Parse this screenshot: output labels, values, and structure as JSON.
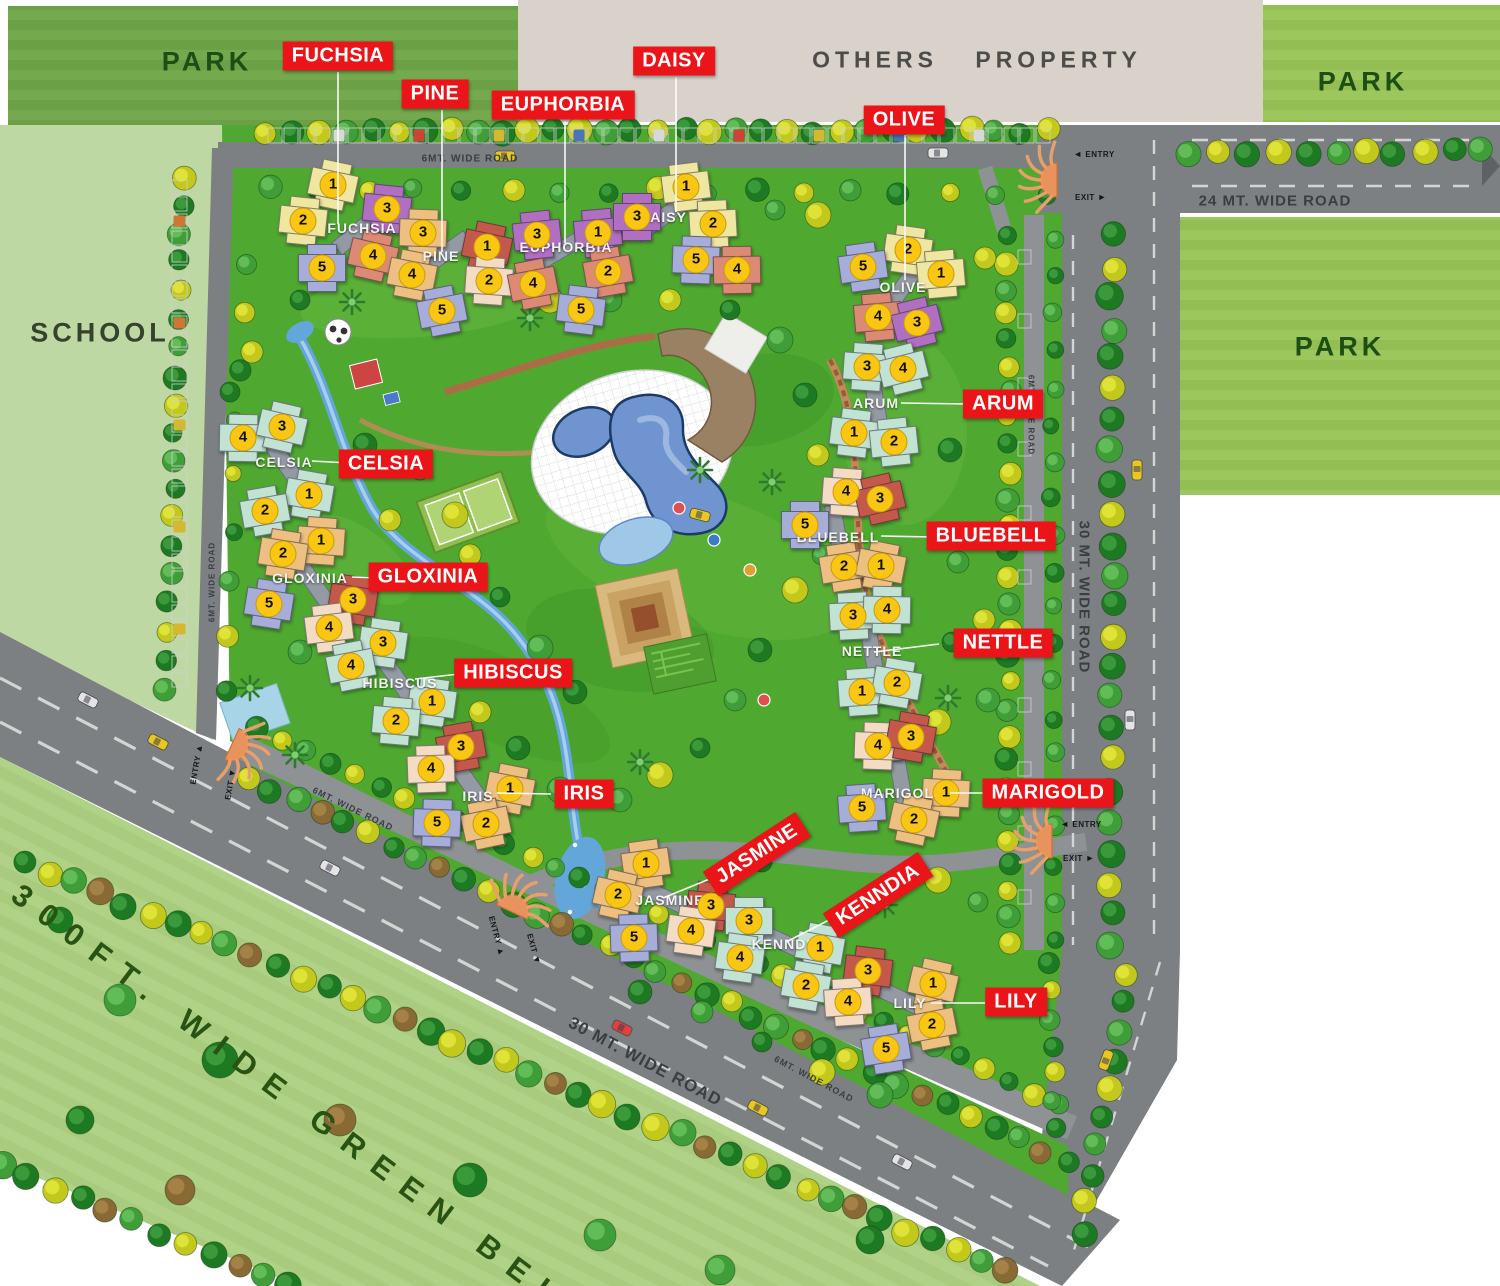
{
  "areas": {
    "park_top_left": {
      "label": "PARK",
      "x": 207,
      "y": 62
    },
    "park_top_right": {
      "label": "PARK",
      "x": 1363,
      "y": 82
    },
    "park_right": {
      "label": "PARK",
      "x": 1340,
      "y": 347
    },
    "school": {
      "label": "SCHOOL",
      "x": 100,
      "y": 333
    },
    "others_property": {
      "label": "OTHERS PROPERTY",
      "x": 977,
      "y": 60
    },
    "green_belt": {
      "label": "300FT. WIDE GREEN BELT",
      "x": 303,
      "y": 1108,
      "rot": 37
    }
  },
  "road_labels": [
    {
      "text": "6MT. WIDE ROAD",
      "x": 470,
      "y": 159,
      "rot": 0,
      "size": 10
    },
    {
      "text": "24 MT. WIDE ROAD",
      "x": 1275,
      "y": 201,
      "rot": 0,
      "size": 15
    },
    {
      "text": "30 MT. WIDE ROAD",
      "x": 1084,
      "y": 597,
      "rot": 90,
      "size": 15
    },
    {
      "text": "6MT. WIDE ROAD",
      "x": 1031,
      "y": 415,
      "rot": 90,
      "size": 8
    },
    {
      "text": "6MT. WIDE ROAD",
      "x": 212,
      "y": 582,
      "rot": -90,
      "size": 8
    },
    {
      "text": "30 MT. WIDE ROAD",
      "x": 645,
      "y": 1062,
      "rot": 28,
      "size": 17
    },
    {
      "text": "6MT. WIDE ROAD",
      "x": 814,
      "y": 1079,
      "rot": 28,
      "size": 9
    },
    {
      "text": "6MT. WIDE ROAD",
      "x": 353,
      "y": 809,
      "rot": 26,
      "size": 9
    }
  ],
  "gates": [
    {
      "x": 1057,
      "y": 180,
      "dir": 180,
      "labels": [
        {
          "text": "ENTRY",
          "arrow": "◄",
          "x": 1094,
          "y": 154,
          "rot": 0
        },
        {
          "text": "EXIT",
          "arrow": "►",
          "x": 1091,
          "y": 197,
          "rot": 0
        }
      ]
    },
    {
      "x": 1052,
      "y": 841,
      "dir": 180,
      "labels": [
        {
          "text": "ENTRY",
          "arrow": "◄",
          "x": 1081,
          "y": 824,
          "rot": 0
        },
        {
          "text": "EXIT",
          "arrow": "►",
          "x": 1079,
          "y": 858,
          "rot": 0
        }
      ]
    },
    {
      "x": 512,
      "y": 912,
      "dir": -65,
      "labels": [
        {
          "text": "ENTRY",
          "arrow": "▲",
          "x": 497,
          "y": 936,
          "rot": 75
        },
        {
          "text": "EXIT",
          "arrow": "▼",
          "x": 534,
          "y": 949,
          "rot": 75
        }
      ]
    },
    {
      "x": 232,
      "y": 744,
      "dir": 25,
      "labels": [
        {
          "text": "ENTRY",
          "arrow": "▲",
          "x": 196,
          "y": 764,
          "rot": -80
        },
        {
          "text": "EXIT",
          "arrow": "▼",
          "x": 230,
          "y": 784,
          "rot": -80
        }
      ]
    }
  ],
  "palette": {
    "yellow": "#efe6a2",
    "purple": "#b06fc1",
    "orange": "#edbf80",
    "salmon": "#dd8a74",
    "lavender": "#a7add9",
    "teal": "#c2e3d4",
    "peach": "#f3dcc3",
    "red": "#c4584a"
  },
  "clusters": [
    {
      "name": "FUCHSIA",
      "label": {
        "x": 362,
        "y": 228
      },
      "spine": -40,
      "callout": {
        "x": 338,
        "y": 56,
        "rot": 0
      },
      "leader": [
        338,
        72,
        338,
        224
      ],
      "towers": [
        {
          "n": "1",
          "x": 333,
          "y": 185,
          "c": "yellow"
        },
        {
          "n": "2",
          "x": 303,
          "y": 221,
          "c": "yellow"
        },
        {
          "n": "3",
          "x": 387,
          "y": 209,
          "c": "purple"
        },
        {
          "n": "4",
          "x": 373,
          "y": 256,
          "c": "salmon"
        },
        {
          "n": "5",
          "x": 322,
          "y": 268,
          "c": "lavender"
        }
      ]
    },
    {
      "name": "PINE",
      "label": {
        "x": 441,
        "y": 256
      },
      "spine": -35,
      "callout": {
        "x": 435,
        "y": 94,
        "rot": 0
      },
      "leader": [
        442,
        110,
        442,
        252
      ],
      "towers": [
        {
          "n": "3",
          "x": 423,
          "y": 233,
          "c": "orange"
        },
        {
          "n": "4",
          "x": 412,
          "y": 275,
          "c": "orange"
        },
        {
          "n": "1",
          "x": 487,
          "y": 247,
          "c": "red"
        },
        {
          "n": "2",
          "x": 489,
          "y": 281,
          "c": "peach"
        },
        {
          "n": "5",
          "x": 442,
          "y": 311,
          "c": "lavender"
        }
      ]
    },
    {
      "name": "EUPHORBIA",
      "label": {
        "x": 566,
        "y": 247
      },
      "spine": -30,
      "callout": {
        "x": 563,
        "y": 105,
        "rot": 0
      },
      "leader": [
        565,
        121,
        565,
        243
      ],
      "towers": [
        {
          "n": "3",
          "x": 537,
          "y": 235,
          "c": "purple"
        },
        {
          "n": "4",
          "x": 533,
          "y": 284,
          "c": "salmon"
        },
        {
          "n": "1",
          "x": 598,
          "y": 233,
          "c": "purple"
        },
        {
          "n": "2",
          "x": 608,
          "y": 272,
          "c": "salmon"
        },
        {
          "n": "5",
          "x": 581,
          "y": 310,
          "c": "lavender"
        }
      ]
    },
    {
      "name": "DAISY",
      "label": {
        "x": 663,
        "y": 217
      },
      "spine": -35,
      "callout": {
        "x": 674,
        "y": 61,
        "rot": 0
      },
      "leader": [
        676,
        77,
        676,
        212
      ],
      "towers": [
        {
          "n": "1",
          "x": 686,
          "y": 187,
          "c": "yellow"
        },
        {
          "n": "3",
          "x": 637,
          "y": 217,
          "c": "purple"
        },
        {
          "n": "2",
          "x": 713,
          "y": 224,
          "c": "yellow"
        },
        {
          "n": "5",
          "x": 696,
          "y": 260,
          "c": "lavender"
        },
        {
          "n": "4",
          "x": 737,
          "y": 270,
          "c": "salmon"
        }
      ]
    },
    {
      "name": "OLIVE",
      "label": {
        "x": 903,
        "y": 287
      },
      "spine": -55,
      "callout": {
        "x": 904,
        "y": 120,
        "rot": 0
      },
      "leader": [
        905,
        135,
        905,
        280
      ],
      "towers": [
        {
          "n": "2",
          "x": 908,
          "y": 250,
          "c": "yellow"
        },
        {
          "n": "1",
          "x": 941,
          "y": 274,
          "c": "yellow"
        },
        {
          "n": "5",
          "x": 863,
          "y": 267,
          "c": "lavender"
        },
        {
          "n": "4",
          "x": 878,
          "y": 317,
          "c": "salmon"
        },
        {
          "n": "3",
          "x": 917,
          "y": 323,
          "c": "purple"
        }
      ]
    },
    {
      "name": "CELSIA",
      "label": {
        "x": 284,
        "y": 462
      },
      "spine": 55,
      "callout": {
        "x": 386,
        "y": 464,
        "rot": 0
      },
      "leader": [
        349,
        463,
        312,
        461
      ],
      "towers": [
        {
          "n": "4",
          "x": 243,
          "y": 438,
          "c": "teal"
        },
        {
          "n": "3",
          "x": 282,
          "y": 427,
          "c": "teal"
        },
        {
          "n": "1",
          "x": 309,
          "y": 495,
          "c": "teal"
        },
        {
          "n": "2",
          "x": 265,
          "y": 511,
          "c": "teal"
        }
      ]
    },
    {
      "name": "GLOXINIA",
      "label": {
        "x": 310,
        "y": 578
      },
      "spine": 55,
      "callout": {
        "x": 428,
        "y": 577,
        "rot": 0
      },
      "leader": [
        374,
        578,
        352,
        577
      ],
      "towers": [
        {
          "n": "1",
          "x": 321,
          "y": 541,
          "c": "orange"
        },
        {
          "n": "2",
          "x": 283,
          "y": 554,
          "c": "orange"
        },
        {
          "n": "3",
          "x": 353,
          "y": 600,
          "c": "red"
        },
        {
          "n": "5",
          "x": 269,
          "y": 604,
          "c": "lavender"
        },
        {
          "n": "4",
          "x": 329,
          "y": 628,
          "c": "peach"
        }
      ]
    },
    {
      "name": "HIBISCUS",
      "label": {
        "x": 400,
        "y": 683
      },
      "spine": 55,
      "callout": {
        "x": 513,
        "y": 673,
        "rot": 0
      },
      "leader": [
        459,
        674,
        415,
        679
      ],
      "towers": [
        {
          "n": "3",
          "x": 383,
          "y": 643,
          "c": "teal"
        },
        {
          "n": "4",
          "x": 351,
          "y": 666,
          "c": "teal"
        },
        {
          "n": "1",
          "x": 432,
          "y": 702,
          "c": "teal"
        },
        {
          "n": "2",
          "x": 396,
          "y": 721,
          "c": "teal"
        }
      ]
    },
    {
      "name": "IRIS",
      "label": {
        "x": 478,
        "y": 796
      },
      "spine": 55,
      "callout": {
        "x": 584,
        "y": 794,
        "rot": 0
      },
      "leader": [
        551,
        794,
        497,
        793
      ],
      "towers": [
        {
          "n": "3",
          "x": 461,
          "y": 747,
          "c": "red"
        },
        {
          "n": "4",
          "x": 431,
          "y": 769,
          "c": "peach"
        },
        {
          "n": "1",
          "x": 510,
          "y": 789,
          "c": "orange"
        },
        {
          "n": "2",
          "x": 486,
          "y": 824,
          "c": "orange"
        },
        {
          "n": "5",
          "x": 437,
          "y": 823,
          "c": "lavender"
        }
      ]
    },
    {
      "name": "ARUM",
      "label": {
        "x": 876,
        "y": 403
      },
      "spine": 80,
      "callout": {
        "x": 1003,
        "y": 404,
        "rot": 0
      },
      "leader": [
        967,
        404,
        901,
        403
      ],
      "towers": [
        {
          "n": "3",
          "x": 867,
          "y": 367,
          "c": "teal"
        },
        {
          "n": "4",
          "x": 903,
          "y": 369,
          "c": "teal"
        },
        {
          "n": "1",
          "x": 854,
          "y": 433,
          "c": "teal"
        },
        {
          "n": "2",
          "x": 894,
          "y": 442,
          "c": "teal"
        }
      ]
    },
    {
      "name": "BLUEBELL",
      "label": {
        "x": 838,
        "y": 537
      },
      "spine": 80,
      "callout": {
        "x": 991,
        "y": 536,
        "rot": 0
      },
      "leader": [
        934,
        537,
        881,
        536
      ],
      "towers": [
        {
          "n": "4",
          "x": 846,
          "y": 492,
          "c": "peach"
        },
        {
          "n": "3",
          "x": 880,
          "y": 499,
          "c": "red"
        },
        {
          "n": "5",
          "x": 805,
          "y": 525,
          "c": "lavender"
        },
        {
          "n": "2",
          "x": 844,
          "y": 567,
          "c": "orange"
        },
        {
          "n": "1",
          "x": 881,
          "y": 566,
          "c": "orange"
        }
      ]
    },
    {
      "name": "NETTLE",
      "label": {
        "x": 872,
        "y": 651
      },
      "spine": 80,
      "callout": {
        "x": 1003,
        "y": 643,
        "rot": 0
      },
      "leader": [
        939,
        644,
        874,
        652
      ],
      "towers": [
        {
          "n": "3",
          "x": 853,
          "y": 616,
          "c": "teal"
        },
        {
          "n": "4",
          "x": 887,
          "y": 610,
          "c": "teal"
        },
        {
          "n": "1",
          "x": 862,
          "y": 692,
          "c": "teal"
        },
        {
          "n": "2",
          "x": 897,
          "y": 683,
          "c": "teal"
        }
      ]
    },
    {
      "name": "MARIGOLD",
      "label": {
        "x": 903,
        "y": 793
      },
      "spine": 80,
      "callout": {
        "x": 1048,
        "y": 793,
        "rot": 0
      },
      "leader": [
        986,
        793,
        950,
        793
      ],
      "towers": [
        {
          "n": "4",
          "x": 878,
          "y": 746,
          "c": "peach"
        },
        {
          "n": "3",
          "x": 911,
          "y": 737,
          "c": "red"
        },
        {
          "n": "5",
          "x": 862,
          "y": 808,
          "c": "lavender"
        },
        {
          "n": "1",
          "x": 946,
          "y": 793,
          "c": "orange"
        },
        {
          "n": "2",
          "x": 914,
          "y": 820,
          "c": "orange"
        }
      ]
    },
    {
      "name": "JASMINE",
      "label": {
        "x": 670,
        "y": 900
      },
      "spine": 25,
      "callout": {
        "x": 757,
        "y": 854,
        "rot": -33
      },
      "leader": [
        712,
        878,
        663,
        898
      ],
      "towers": [
        {
          "n": "1",
          "x": 646,
          "y": 864,
          "c": "orange"
        },
        {
          "n": "2",
          "x": 618,
          "y": 895,
          "c": "orange"
        },
        {
          "n": "3",
          "x": 711,
          "y": 906,
          "c": "red"
        },
        {
          "n": "5",
          "x": 634,
          "y": 938,
          "c": "lavender"
        },
        {
          "n": "4",
          "x": 691,
          "y": 931,
          "c": "peach"
        }
      ]
    },
    {
      "name": "KENNDIA",
      "label": {
        "x": 787,
        "y": 944
      },
      "spine": 25,
      "callout": {
        "x": 878,
        "y": 895,
        "rot": -33
      },
      "leader": [
        833,
        918,
        788,
        941
      ],
      "towers": [
        {
          "n": "3",
          "x": 749,
          "y": 921,
          "c": "teal"
        },
        {
          "n": "1",
          "x": 820,
          "y": 948,
          "c": "teal"
        },
        {
          "n": "4",
          "x": 740,
          "y": 958,
          "c": "teal"
        },
        {
          "n": "2",
          "x": 806,
          "y": 986,
          "c": "teal"
        }
      ]
    },
    {
      "name": "LILY",
      "label": {
        "x": 910,
        "y": 1003
      },
      "spine": 25,
      "callout": {
        "x": 1016,
        "y": 1002,
        "rot": 0
      },
      "leader": [
        985,
        1003,
        931,
        1003
      ],
      "towers": [
        {
          "n": "3",
          "x": 868,
          "y": 971,
          "c": "red"
        },
        {
          "n": "1",
          "x": 933,
          "y": 984,
          "c": "orange"
        },
        {
          "n": "4",
          "x": 848,
          "y": 1002,
          "c": "peach"
        },
        {
          "n": "2",
          "x": 932,
          "y": 1025,
          "c": "orange"
        },
        {
          "n": "5",
          "x": 886,
          "y": 1049,
          "c": "lavender"
        }
      ]
    }
  ]
}
